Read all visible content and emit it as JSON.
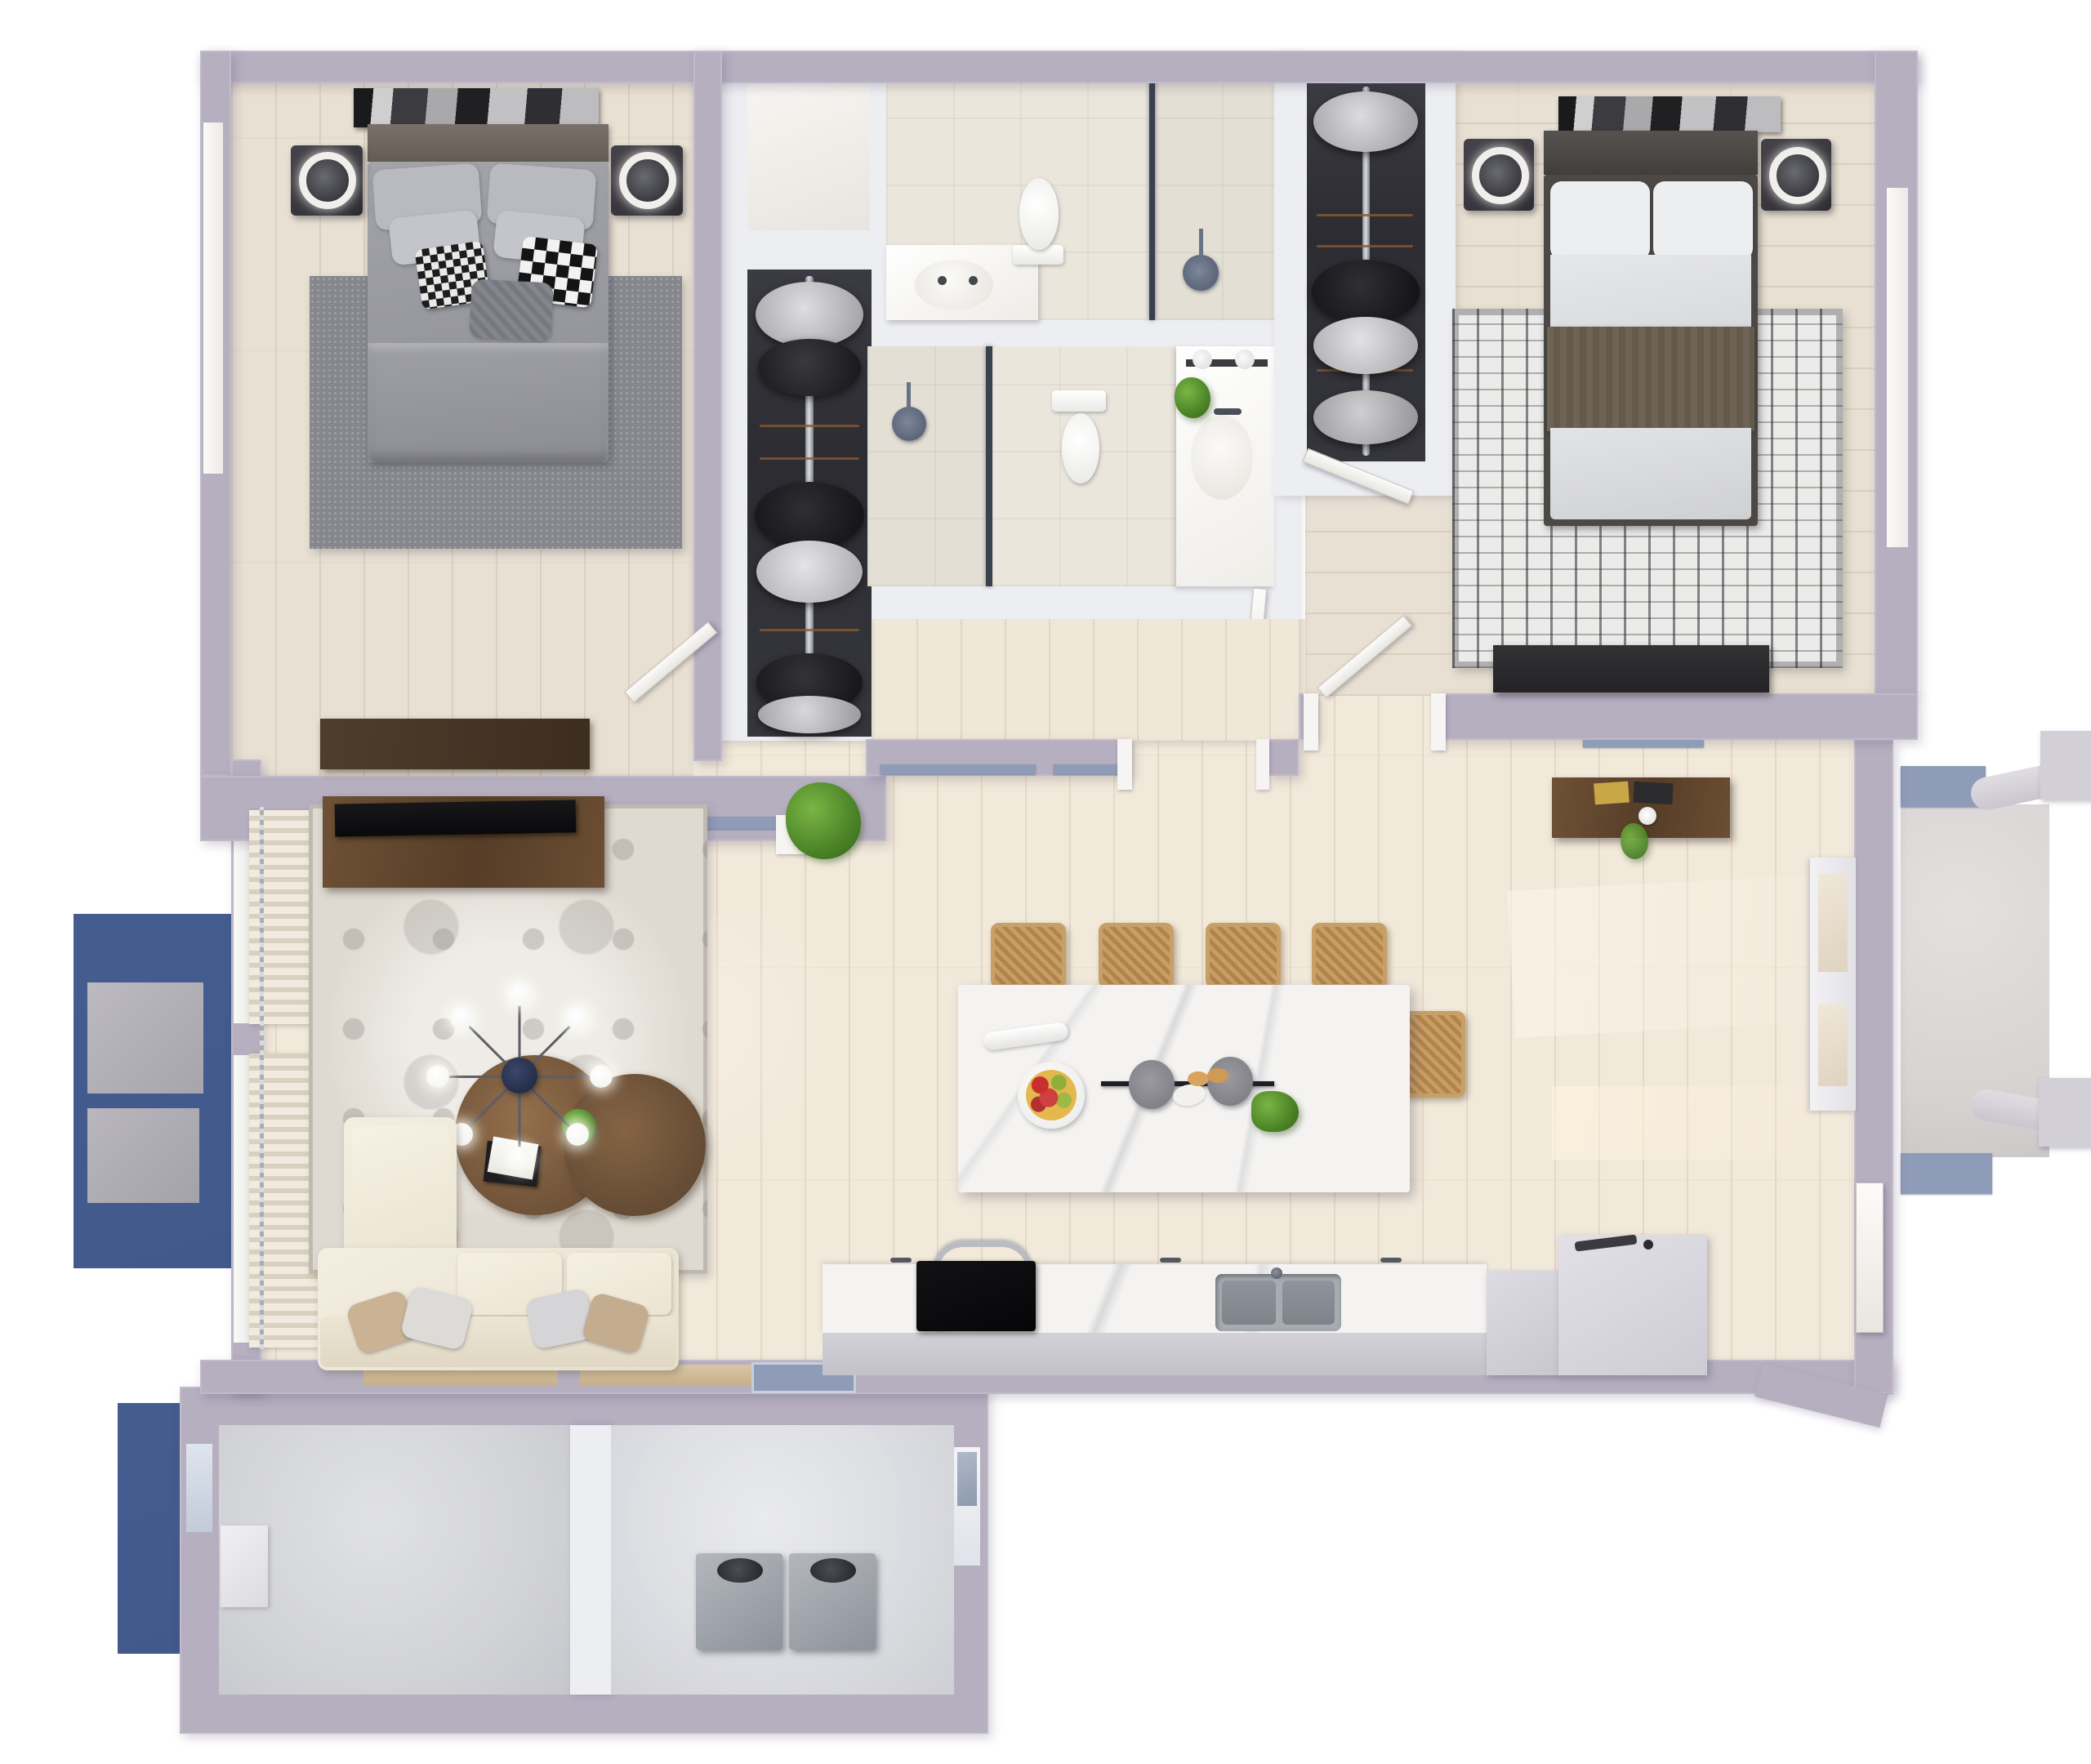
{
  "meta": {
    "title": "Two-Bedroom Apartment — 3D Top-Down Floor Plan Render",
    "view": "top-down orthographic 3D render",
    "text_on_screen": "none"
  },
  "palette": {
    "wall": "#b6afc0",
    "wall_white": "#edeef2",
    "floor_wood": "#e8e0d2",
    "tile": "#ebe6dc",
    "concrete": "#d2d3d7",
    "deck_blue": "#41598c",
    "track_blue": "#8f9cb8",
    "marble": "#f4f3f1",
    "walnut": "#6b4e33",
    "sofa_cream": "#f0ebdd",
    "rattan": "#c49a63",
    "steel": "#9aa0a7",
    "plant_green": "#5b9a34",
    "sill_tan": "#cdb592"
  },
  "rooms": {
    "bedroom1": {
      "label": "Bedroom 1 (top-left)"
    },
    "bedroom2": {
      "label": "Bedroom 2 (top-right)"
    },
    "bath1": {
      "label": "Bathroom 1 with shower"
    },
    "bath2": {
      "label": "Bathroom 2 with shower"
    },
    "closet1": {
      "label": "Walk-in closet 1"
    },
    "closet2": {
      "label": "Walk-in closet 2"
    },
    "linen": {
      "label": "Linen closet"
    },
    "living": {
      "label": "Living room"
    },
    "kitchen": {
      "label": "Kitchen"
    },
    "hall": {
      "label": "Open hall / dining"
    },
    "storage": {
      "label": "Storage room"
    },
    "utility": {
      "label": "Utility room with water heaters"
    },
    "deck_left": {
      "label": "Side deck with planters"
    },
    "deck_lower": {
      "label": "Lower deck"
    },
    "porch": {
      "label": "Entry porch with railings"
    }
  },
  "furniture": {
    "bed1": {
      "label": "Queen bed, gray bedding, houndstooth pillows"
    },
    "bed2": {
      "label": "Queen bed, white bedding, brown throw"
    },
    "nightstand": {
      "label": "Dark nightstand with ring lamp"
    },
    "dresser1": {
      "label": "Walnut dresser"
    },
    "dresser2": {
      "label": "Black low dresser"
    },
    "tv_console": {
      "label": "Walnut TV console with flat-screen TV"
    },
    "hall_console": {
      "label": "Walnut entry console with books and plant"
    },
    "sofa": {
      "label": "Cream sectional sofa with chaise"
    },
    "coffee_tables": {
      "label": "Round walnut nesting coffee tables"
    },
    "chandelier": {
      "label": "Sputnik chandelier, 8 globe bulbs"
    },
    "rug_living": {
      "label": "Ornate vintage rug"
    },
    "rug_bed1": {
      "label": "Gray area rug"
    },
    "rug_bed2": {
      "label": "Black-and-white boho rug"
    },
    "island": {
      "label": "Marble waterfall island"
    },
    "stools": {
      "label": "Rattan counter stools (5)"
    },
    "pendant": {
      "label": "Linear two-shade pendant"
    },
    "fruit_bowl": {
      "label": "Bowl of apples"
    },
    "vase": {
      "label": "White vase"
    },
    "greens": {
      "label": "Leafy greens"
    },
    "cooktop": {
      "label": "Black range with steel handle"
    },
    "sink_kitchen": {
      "label": "Double-basin undermount sink"
    },
    "cabinets_right": {
      "label": "Tall gray cabinets / refrigerator"
    },
    "toilet": {
      "label": "Toilet"
    },
    "vanity": {
      "label": "Vanity with sink"
    },
    "shower": {
      "label": "Glass walk-in shower"
    },
    "clothes_rack": {
      "label": "Pole rack with hanging clothes"
    },
    "washer": {
      "label": "Stainless top-load unit"
    },
    "plant_floor": {
      "label": "Potted green plant"
    },
    "curtains": {
      "label": "Cream sheer curtains"
    },
    "front_door": {
      "label": "Front entry door"
    },
    "planter": {
      "label": "Gray deck planter"
    },
    "window": {
      "label": "Window"
    },
    "slider_track": {
      "label": "Sliding glass door track"
    }
  }
}
